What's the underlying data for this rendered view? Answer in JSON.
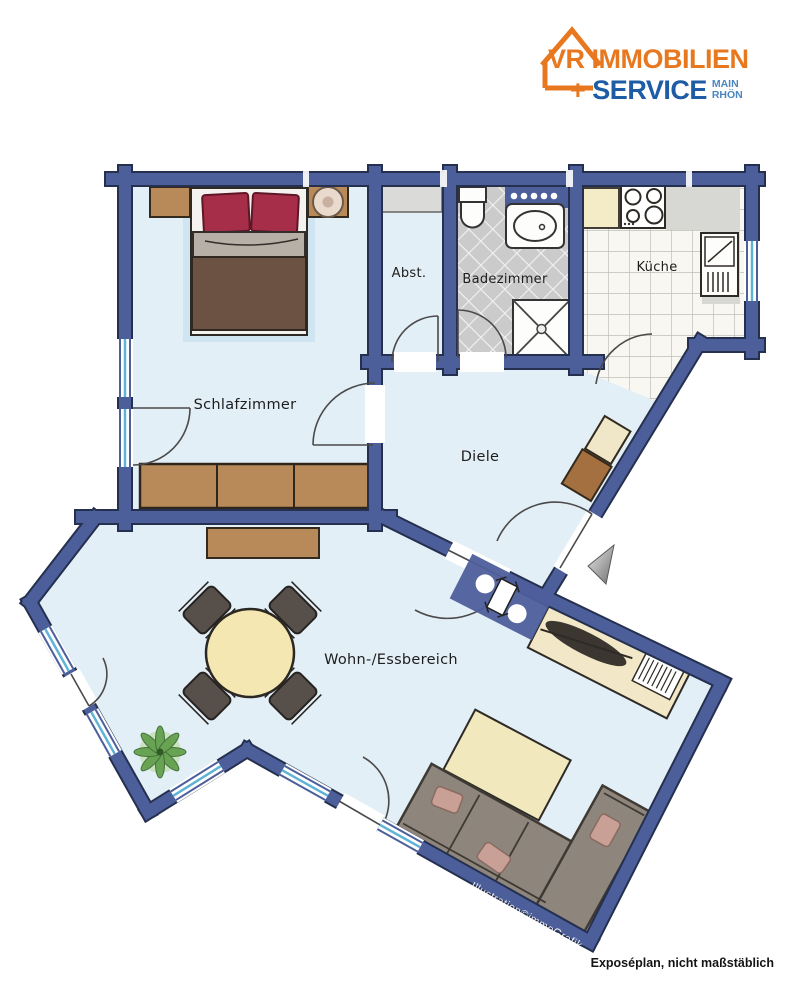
{
  "logo": {
    "brand": "VR IMMOBILIEN",
    "plus": "+",
    "service": "SERVICE",
    "region_line1": "MAIN",
    "region_line2": "RHÖN"
  },
  "rooms": {
    "schlafzimmer": "Schlafzimmer",
    "abstellraum": "Abst.",
    "badezimmer": "Badezimmer",
    "kueche": "Küche",
    "diele": "Diele",
    "wohn_essbereich": "Wohn-/Essbereich"
  },
  "watermark": {
    "credit": "Illustration©immoGrafik"
  },
  "footer": {
    "note": "Exposéplan, nicht maßstäblich"
  },
  "icons": {
    "logo_house": "house-outline-icon",
    "entrance": "entrance-arrow-icon"
  },
  "colors": {
    "wall_blue": "#4d5f9b",
    "wall_edge": "#25304f",
    "floor": "#e3eff6",
    "bath_tile": "#cbcbcb",
    "kitchen_tile": "#f8f7f2",
    "wood": "#b98a59",
    "bed_duvet": "#6b5243",
    "pillow_red": "#a72e49",
    "cream_furniture": "#f2e6b8",
    "sofa_gray": "#8e867d",
    "window_cyan": "#5fb3d4",
    "logo_orange": "#e87820",
    "logo_blue": "#1e5ca5",
    "logo_light_blue": "#4b86c0",
    "plant_green": "#5f9e4a"
  }
}
